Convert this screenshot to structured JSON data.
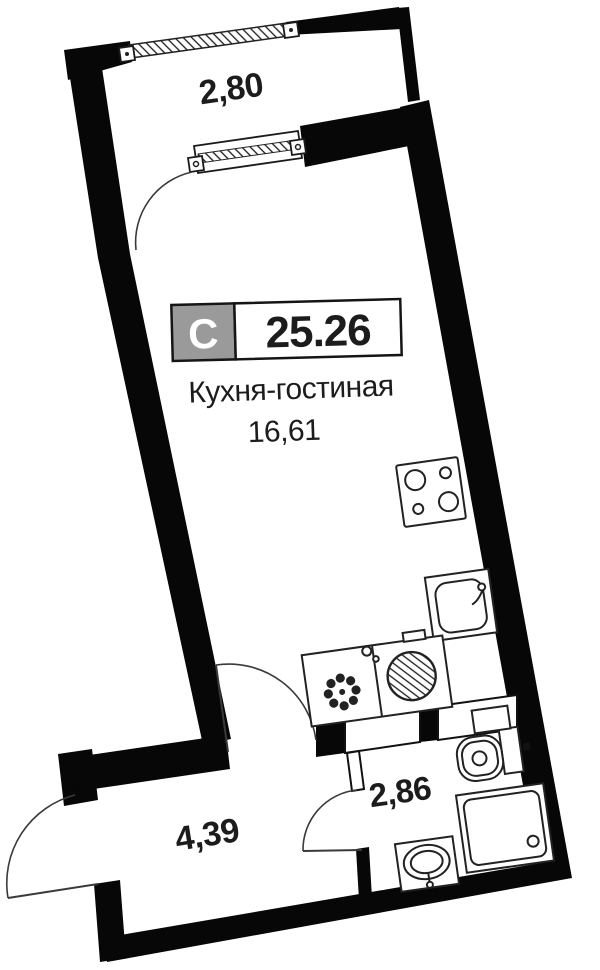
{
  "floorplan": {
    "unit_badge": {
      "letter": "С",
      "total_area": "25.26"
    },
    "kitchen_living": {
      "label": "Кухня-гостиная",
      "area": "16,61"
    },
    "hallway": {
      "area": "4,39"
    },
    "bathroom": {
      "area": "2,86"
    },
    "balcony": {
      "width": "2,80"
    },
    "colors": {
      "wall": "#070707",
      "badge_gray": "#9a9a9a",
      "badge_border": "#151515",
      "text": "#1c1c1c",
      "background": "#ffffff"
    },
    "fixtures": [
      "stove-icon",
      "kitchen-sink-icon",
      "fan-appliance-icon",
      "washing-machine-icon",
      "toilet-icon",
      "vent-shaft",
      "shower-tray-icon",
      "washbasin-icon",
      "window-glazing",
      "balcony-door",
      "entrance-door",
      "room-door",
      "bathroom-door"
    ]
  }
}
